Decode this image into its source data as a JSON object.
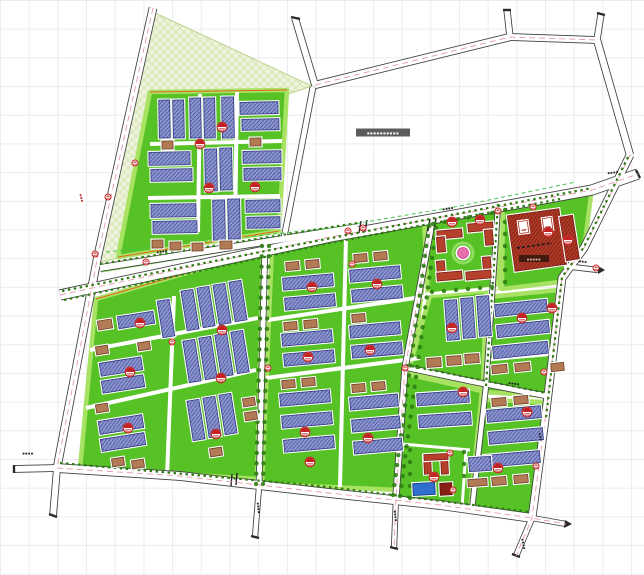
{
  "canvas": {
    "width": 644,
    "height": 575
  },
  "labels": {
    "reserved_area_tag": "▪▪▪▪▪▪▪▪▪▪",
    "school_plate": "▪▪▪▪▪",
    "road_label_a": "▪▪▪▪",
    "road_label_b": "▪▪▪▪",
    "road_label_c": "▪▪▪▪",
    "road_label_d": "▪▪▪",
    "road_label_e": "▪▪▪▪",
    "road_label_f": "▪▪▪▪",
    "road_label_g": "▪▪▪▪",
    "road_label_h": "▪▪▪▪",
    "road_label_i": "▪▪▪",
    "road_label_j": "▪▪▪▪",
    "road_label_k": "▪▪▪"
  },
  "colors": {
    "grid": "#ececec",
    "road_casing": "#3f3f3f",
    "road_fill": "#ffffff",
    "centerline_pink": "#e49ab0",
    "lawn": "#57c226",
    "hedge": "#a8e262",
    "pale_area": "#eef3de",
    "pale_hatch": "#d4e4ac",
    "tree": "#2e7d12",
    "boundary_dash_green": "#49c64f",
    "building_blue": "#8d96cf",
    "building_blue_hatch": "#4d57a0",
    "building_blue_border": "#2e3a7e",
    "building_brown": "#b37b55",
    "building_brown_border": "#6e4226",
    "building_red": "#b03a28",
    "building_red_hatch": "#7c1f12",
    "building_dark_red": "#8a2015",
    "pool_blue": "#2f6fd0",
    "stamp_red": "#c32222",
    "plaza_pink": "#e86fae",
    "label_bar": "#5c5c5c",
    "label_bar_text": "#f0f0f0",
    "plate_bar": "#431a10",
    "plate_text": "#e9b9ac",
    "redline_orange": "#e2641e",
    "cap_dark": "#2a2a2a"
  }
}
